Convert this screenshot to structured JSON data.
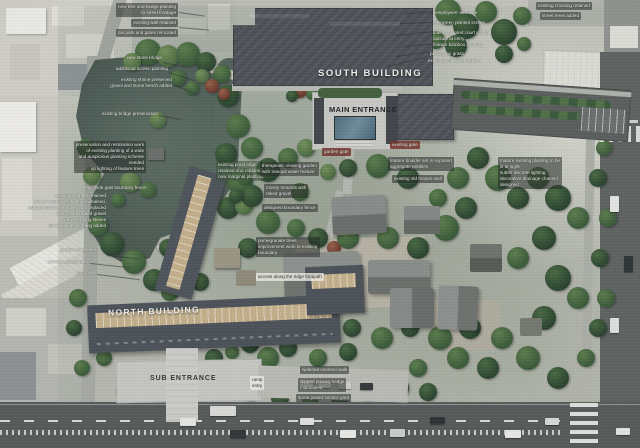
{
  "labels": {
    "south_building": "SOUTH BUILDING",
    "main_entrance": "MAIN ENTRANCE",
    "north_building": "NORTH BUILDING",
    "sub_entrance": "SUB ENTRANCE"
  },
  "colors": {
    "pond_water": "#42524d",
    "roof_dark_slate": "#4c5157",
    "temple_roof_gray": "#7e8280",
    "balcony_tan": "#c2ae8b",
    "entrance_water_feature": "#50707f",
    "road_asphalt": "#575c5b",
    "plaza_paving": "#c6c7c3",
    "tree_dark_green": "#2f4732",
    "tree_light_green": "#657f52",
    "annotation_red_box": "#783428"
  },
  "annotations": [
    {
      "x": 178,
      "y": 3,
      "align": "right",
      "style": "box",
      "lines": [
        "new tree and hedge planting",
        "to street frontage"
      ]
    },
    {
      "x": 178,
      "y": 19,
      "align": "right",
      "style": "box",
      "lines": [
        "existing wall retained"
      ]
    },
    {
      "x": 178,
      "y": 29,
      "align": "right",
      "style": "box",
      "lines": [
        "car park and gates relocated"
      ]
    },
    {
      "x": 162,
      "y": 55,
      "align": "right",
      "style": "plain",
      "lines": [
        "new stone bridge"
      ]
    },
    {
      "x": 168,
      "y": 66,
      "align": "right",
      "style": "plain",
      "lines": [
        "additional screen planting"
      ]
    },
    {
      "x": 172,
      "y": 77,
      "align": "right",
      "style": "plain",
      "lines": [
        "existing shrine preserved",
        "gravel and stone bench added"
      ]
    },
    {
      "x": 158,
      "y": 111,
      "align": "right",
      "style": "plain",
      "lines": [
        "existing bridge preservation"
      ]
    },
    {
      "x": 146,
      "y": 141,
      "align": "right",
      "style": "box",
      "lines": [
        "preservation and restoration work",
        "of existing planting of a wide",
        "and auspicious planting scheme",
        "needed",
        "up lighting of feature trees"
      ]
    },
    {
      "x": 146,
      "y": 185,
      "align": "right",
      "style": "plain",
      "lines": [
        "new shide gaki boundary fence"
      ]
    },
    {
      "x": 216,
      "y": 161,
      "align": "left",
      "style": "green",
      "lines": [
        "existing pond edge",
        "retained and repaired",
        "new marginal planting"
      ]
    },
    {
      "x": 260,
      "y": 162,
      "align": "left",
      "style": "box",
      "lines": [
        "therapeutic viewing garden",
        "with tranquil water feature"
      ]
    },
    {
      "x": 264,
      "y": 184,
      "align": "left",
      "style": "box",
      "lines": [
        "mossy mounds with",
        "raked gravel"
      ]
    },
    {
      "x": 262,
      "y": 204,
      "align": "left",
      "style": "box",
      "lines": [
        "designed boundary fence"
      ]
    },
    {
      "x": 322,
      "y": 148,
      "align": "left",
      "style": "red",
      "lines": [
        "garden gate"
      ]
    },
    {
      "x": 390,
      "y": 141,
      "align": "left",
      "style": "red",
      "lines": [
        "existing gate"
      ]
    },
    {
      "x": 388,
      "y": 157,
      "align": "left",
      "style": "box",
      "lines": [
        "feature boulder set in exposed",
        "aggregate pebbles"
      ]
    },
    {
      "x": 392,
      "y": 175,
      "align": "left",
      "style": "box",
      "lines": [
        "existing old feature wall"
      ]
    },
    {
      "x": 256,
      "y": 237,
      "align": "left",
      "style": "box",
      "lines": [
        "pomegranate trees",
        "improvement work to existing",
        "boundary"
      ]
    },
    {
      "x": 256,
      "y": 273,
      "align": "left",
      "style": "light",
      "lines": [
        "access along the ridge footpath"
      ]
    },
    {
      "x": 250,
      "y": 376,
      "align": "left",
      "style": "light",
      "lines": [
        "ramp",
        "entry"
      ]
    },
    {
      "x": 300,
      "y": 366,
      "align": "left",
      "style": "box",
      "lines": [
        "widened covered walk"
      ]
    },
    {
      "x": 298,
      "y": 378,
      "align": "left",
      "style": "box",
      "lines": [
        "clipped privacy hedge",
        "maintained"
      ]
    },
    {
      "x": 296,
      "y": 394,
      "align": "left",
      "style": "box",
      "lines": [
        "stone paved service yard"
      ]
    },
    {
      "x": 106,
      "y": 193,
      "align": "right",
      "style": "plain",
      "lines": [
        "existing footpath retained",
        "line of existing footpath maintained,",
        "asphalt surface removed and replaced",
        "with resin bonded gravel",
        "new stepping stones",
        "low level path lighting added"
      ]
    },
    {
      "x": 96,
      "y": 247,
      "align": "right",
      "style": "plain",
      "lines": [
        "garden tea house"
      ]
    },
    {
      "x": 88,
      "y": 259,
      "align": "right",
      "style": "plain",
      "lines": [
        "service access path"
      ]
    },
    {
      "x": 96,
      "y": 270,
      "align": "right",
      "style": "plain",
      "lines": [
        "tea house"
      ]
    },
    {
      "x": 435,
      "y": 10,
      "align": "left",
      "style": "plain",
      "lines": [
        "employees' entrance"
      ]
    },
    {
      "x": 433,
      "y": 20,
      "align": "left",
      "style": "plain",
      "lines": [
        "evergreen planted screen"
      ]
    },
    {
      "x": 433,
      "y": 30,
      "align": "left",
      "style": "plain",
      "lines": [
        "interior planted court visible",
        "outside at entry"
      ]
    },
    {
      "x": 433,
      "y": 42,
      "align": "left",
      "style": "plain",
      "lines": [
        "feature bamboo planting"
      ]
    },
    {
      "x": 430,
      "y": 51,
      "align": "left",
      "style": "plain",
      "lines": [
        "parking on grass"
      ]
    },
    {
      "x": 428,
      "y": 58,
      "align": "left",
      "style": "plain",
      "lines": [
        "existing wall water feature"
      ]
    },
    {
      "x": 498,
      "y": 157,
      "align": "left",
      "style": "box",
      "lines": [
        "mature existing planting to be",
        "lit at night",
        "subtle discrete lighting",
        "decorative drainage channel",
        "designed"
      ]
    },
    {
      "x": 536,
      "y": 2,
      "align": "left",
      "style": "box",
      "lines": [
        "existing crossing retained"
      ]
    },
    {
      "x": 540,
      "y": 12,
      "align": "left",
      "style": "box",
      "lines": [
        "street trees added"
      ]
    }
  ]
}
